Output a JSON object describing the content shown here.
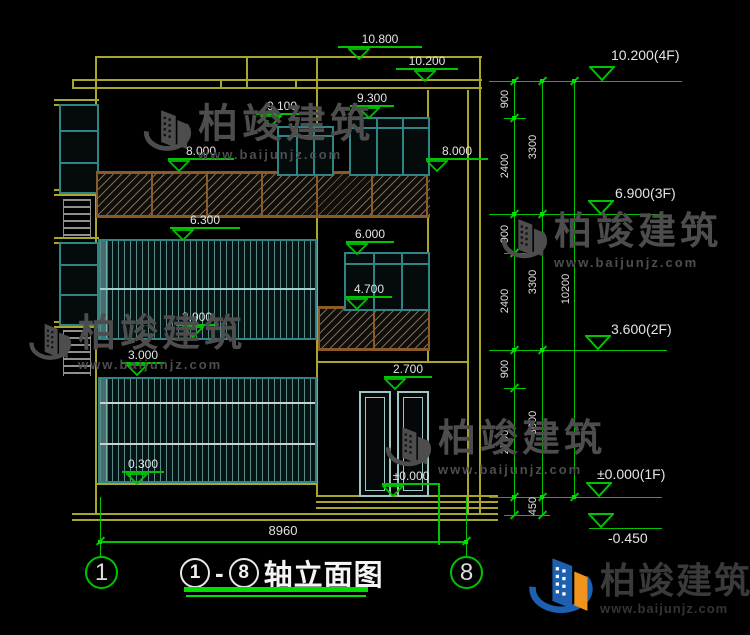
{
  "drawing": {
    "elevations": {
      "v10800": "10.800",
      "v10200": "10.200",
      "v9100": "9.100",
      "v9300": "9.300",
      "v8000_left": "8.000",
      "v8000_right": "8.000",
      "v6300": "6.300",
      "v6000": "6.000",
      "v4700": "4.700",
      "v3900": "3.900",
      "v3000": "3.000",
      "v2700": "2.700",
      "v0300": "0.300",
      "v0000": "±0.000"
    },
    "axis": {
      "left": "1",
      "right": "8"
    },
    "bottom_dimension": "8960"
  },
  "dimension_panel": {
    "floor_labels": {
      "f4": "10.200(4F)",
      "f3": "6.900(3F)",
      "f2": "3.600(2F)",
      "f1": "±0.000(1F)",
      "ground": "-0.450"
    },
    "segments_inner": [
      "900",
      "2400",
      "900",
      "2400",
      "900",
      "2700"
    ],
    "segments_outer": [
      "3300",
      "3300",
      "3600",
      "450"
    ],
    "total_height": "10200"
  },
  "title_block": {
    "axis_from": "1",
    "dash": "-",
    "axis_to": "8",
    "title_text": "轴立面图"
  },
  "watermark": {
    "brand": "柏竣建筑",
    "url": "www.baijunjz.com"
  },
  "footer_logo": {
    "brand": "柏竣建筑",
    "url": "www.baijunjz.com"
  },
  "colors": {
    "line_yellow": "#a9a62c",
    "dim_green": "#00c400",
    "frame_teal": "#2f8585",
    "rail_brown": "#8a5a28",
    "watermark_gray": "#4d4d4d",
    "logo_blue": "#1d5fb0",
    "logo_orange": "#f0941e"
  }
}
